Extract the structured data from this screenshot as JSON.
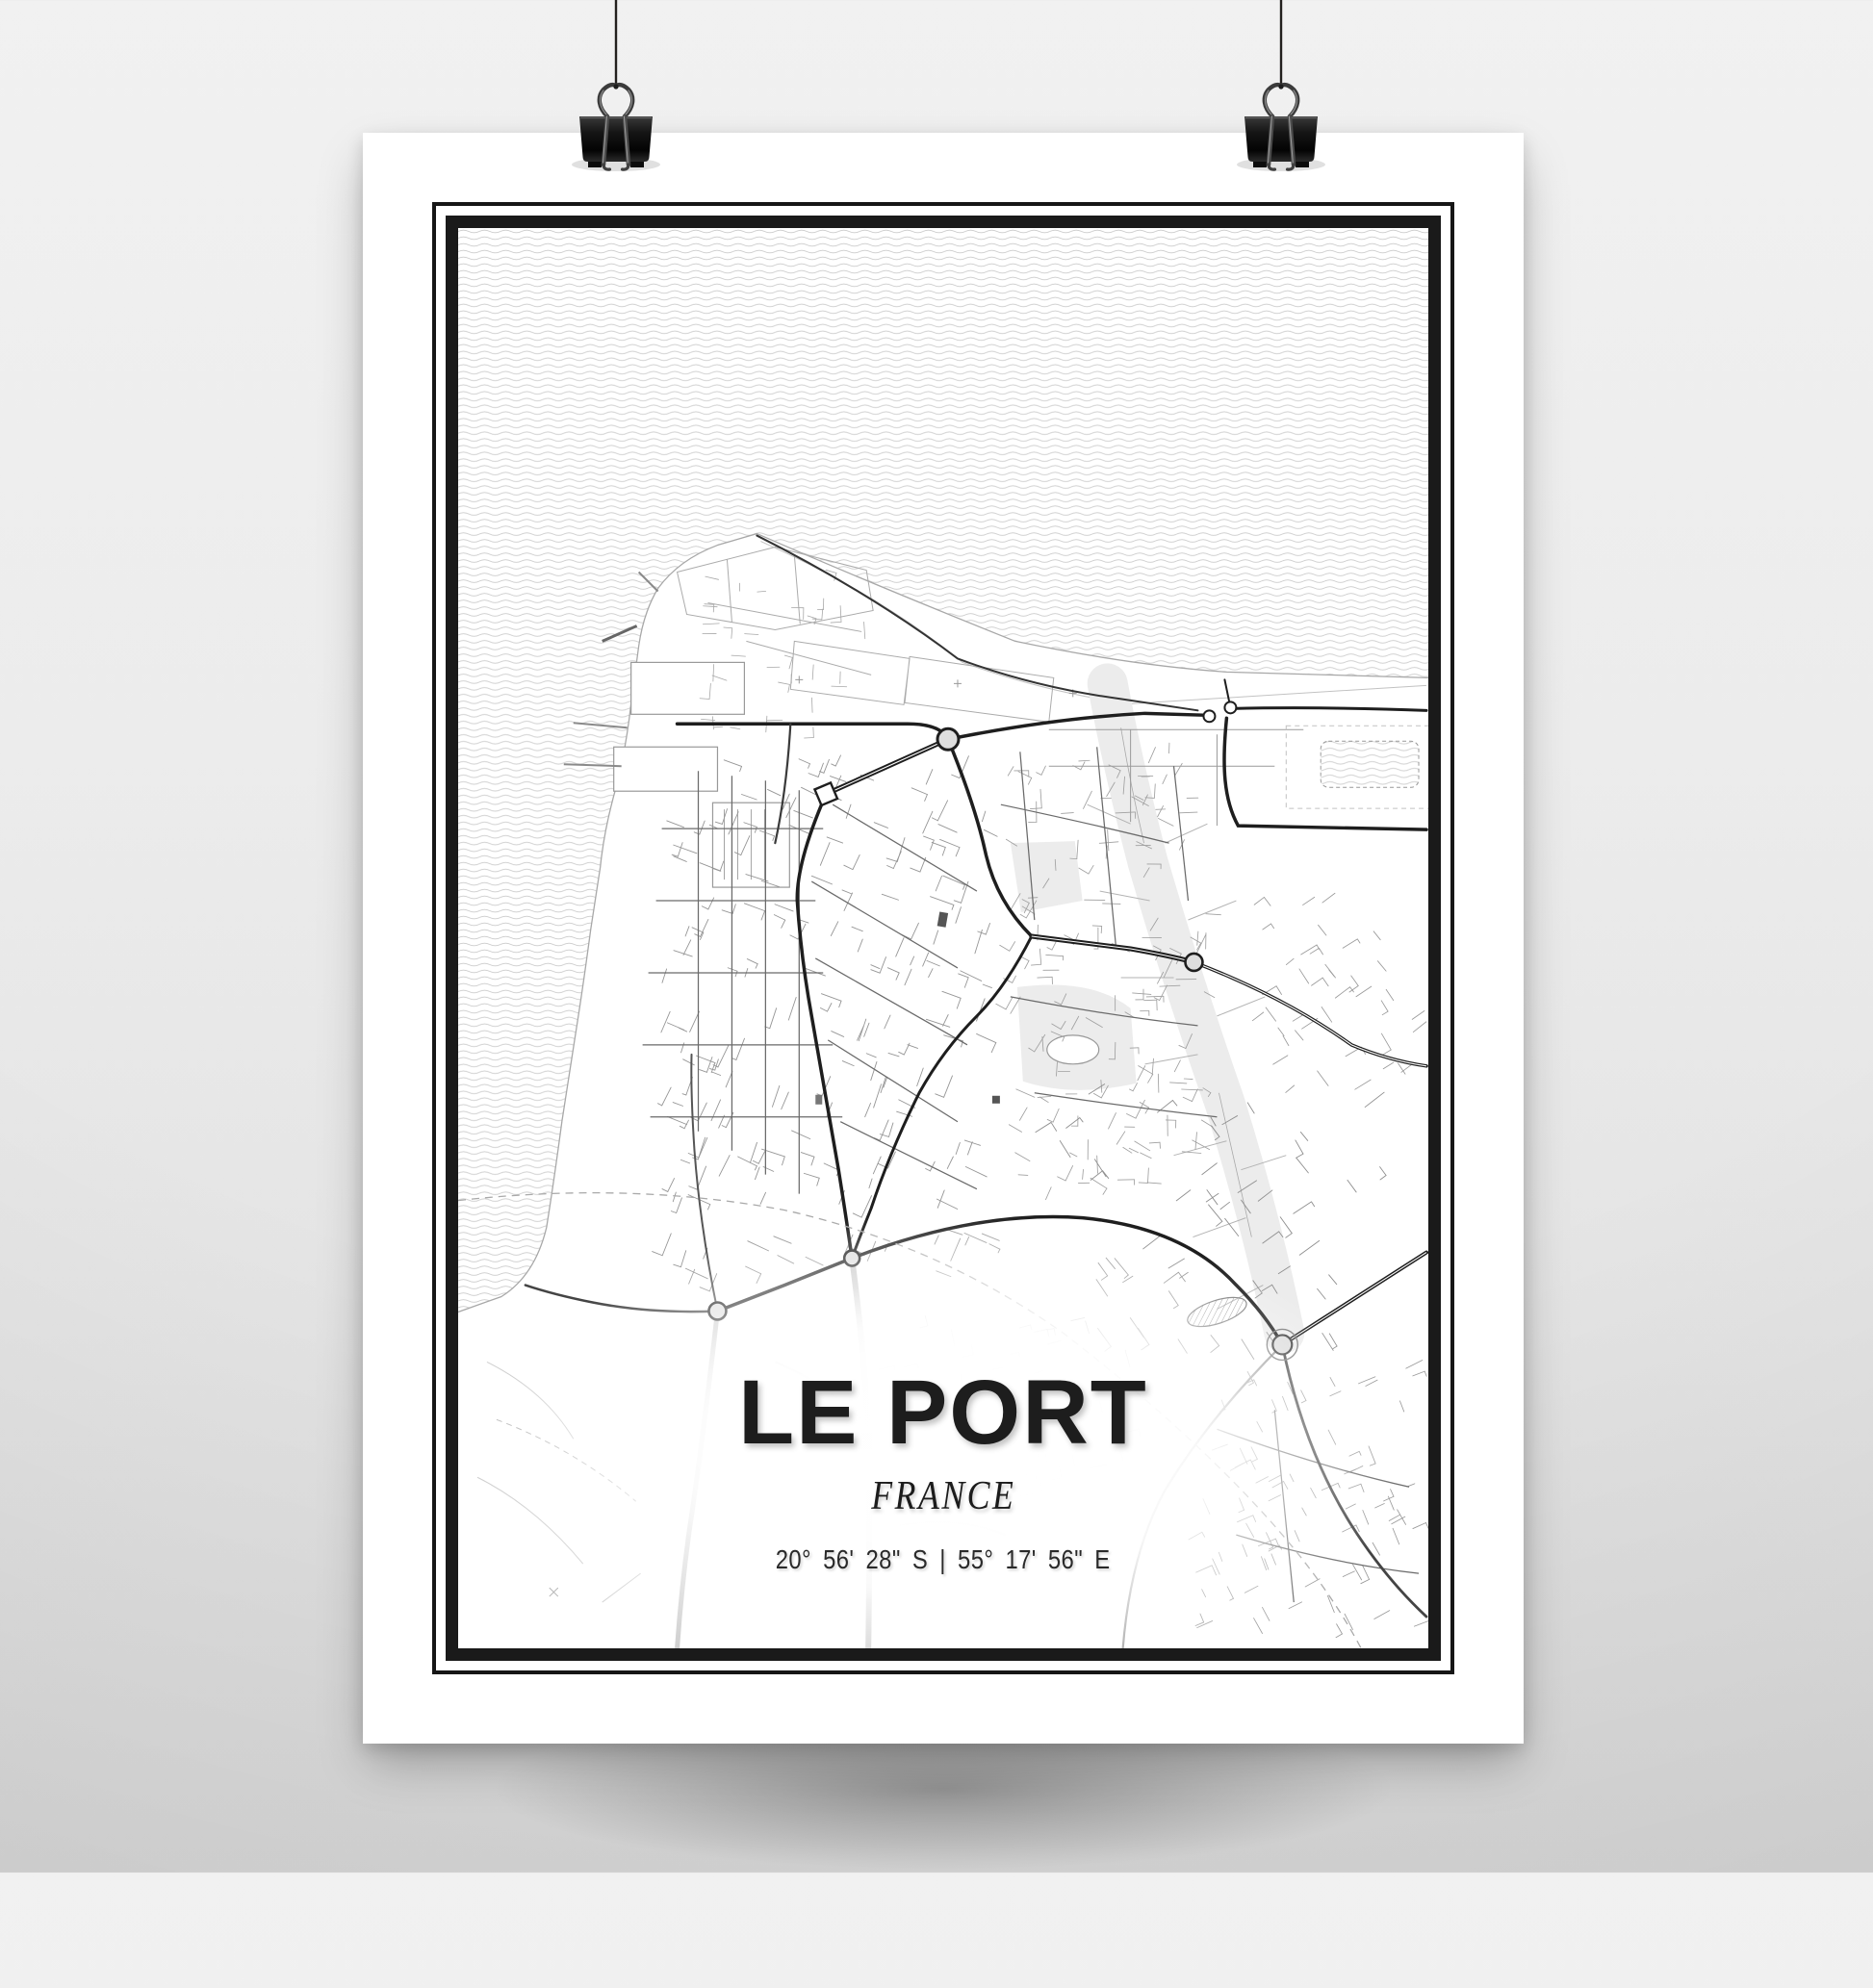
{
  "poster": {
    "title": "LE PORT",
    "subtitle": "FRANCE",
    "coordinates": "20° 56' 28\" S | 55° 17' 56\" E"
  },
  "colors": {
    "paper": "#ffffff",
    "ink": "#1d1d1d",
    "frame": "#161616",
    "wave_lines": "#cbcbcb",
    "coastline": "#a8a8a8",
    "road_major": "#1e1e1e",
    "road_medium": "#6a6a6a",
    "road_minor": "#a0a0a0",
    "riverbed": "#ececec",
    "wall_background": "#ececec",
    "binder_clip": "#141414"
  }
}
